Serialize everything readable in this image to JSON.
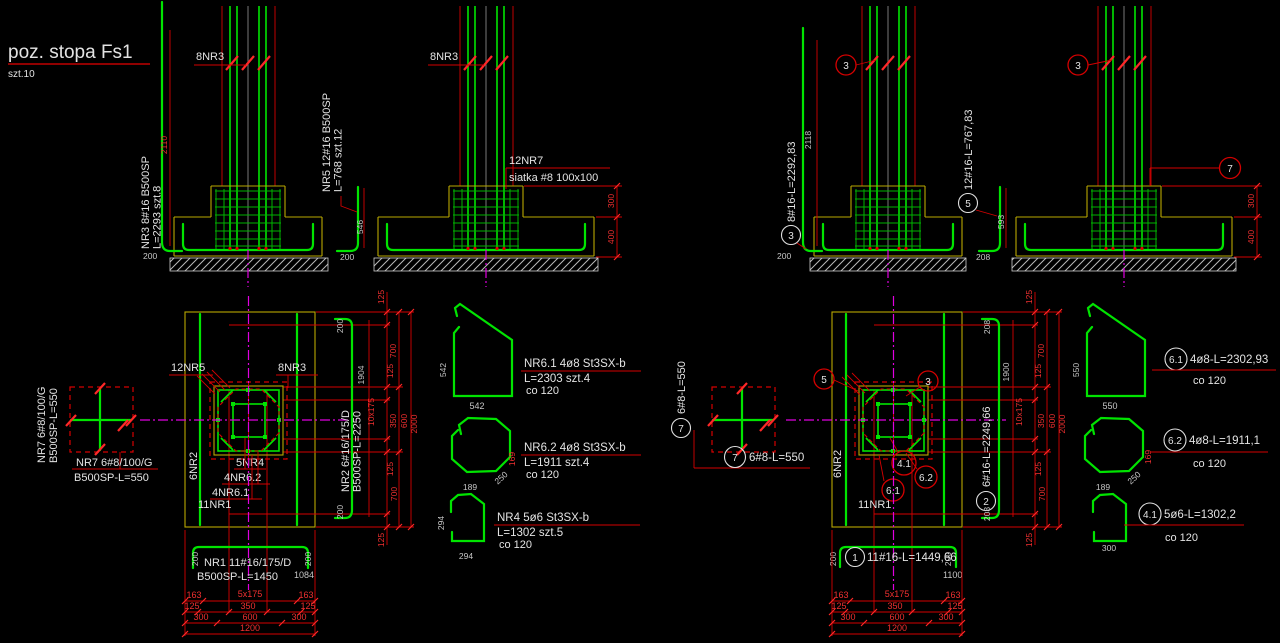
{
  "title": {
    "main": "poz. stopa  Fs1",
    "count": "szt.10"
  },
  "left": {
    "elev1": {
      "bars": "8NR3",
      "bar_name": "NR3  8#16  B500SP",
      "bar_len": "L=2293  szt.8",
      "bar_dim": "2110",
      "hook": "200"
    },
    "elev2": {
      "bars": "8NR3",
      "bar_name": "NR5  12#16  B500SP",
      "bar_len": "L=768  szt.12",
      "bar_dim": "546",
      "hook": "200",
      "mesh1": "12NR7",
      "mesh2": "siatka #8 100x100",
      "dim300": "300",
      "dim400": "400"
    },
    "nr7": {
      "rot1": "NR7 6#8/100/G",
      "rot2": "B500SP-L=550",
      "h1": "NR7 6#8/100/G",
      "h2": "B500SP-L=550"
    },
    "plan": {
      "nr5": "12NR5",
      "nr3": "8NR3",
      "nr2": "6NR2",
      "nr4": "5NR4",
      "nr62": "4NR6.2",
      "nr61": "4NR6.1",
      "nr1": "11NR1",
      "hook_top": "200",
      "bar_dim": "1904",
      "bar_name": "NR2 6#16/175/D",
      "bar_len": "B500SP-L=2250",
      "hook_bot": "200",
      "v125a": "125",
      "v700a": "700",
      "v125b": "125",
      "v10x175": "10x175",
      "v350": "350",
      "v600": "600",
      "v2000": "2000",
      "v125c": "125",
      "v700b": "700",
      "v125d": "125"
    },
    "bar1": {
      "hook_l": "200",
      "hook_r": "200",
      "name": "NR1 11#16/175/D",
      "len": "B500SP-L=1450",
      "dim": "1084"
    },
    "hdim": {
      "a1": "163",
      "a2": "5x175",
      "a3": "163",
      "b1": "125",
      "b2": "350",
      "b3": "125",
      "c1": "300",
      "c2": "600",
      "c3": "300",
      "d1": "1200"
    },
    "d61": {
      "t": "NR6.1  4ø8  St3SX-b",
      "l": "L=2303  szt.4",
      "co": "co 120",
      "dl": "542",
      "db": "542"
    },
    "d62": {
      "t": "NR6.2  4ø8  St3SX-b",
      "l": "L=1911  szt.4",
      "co": "co 120",
      "db": "189",
      "dd": "250",
      "dr": "169"
    },
    "d4": {
      "t": "NR4  5ø6  St3SX-b",
      "l": "L=1302  szt.5",
      "co": "co 120",
      "dl": "294",
      "db": "294"
    }
  },
  "right": {
    "elev1": {
      "callout": "3",
      "no": "3",
      "label": "8#16-L=2292,83",
      "dim": "2118",
      "hook": "200"
    },
    "elev2": {
      "callout": "3",
      "no": "5",
      "label": "12#16-L=767,83",
      "dim": "593",
      "hook": "208",
      "mesh_no": "7",
      "dim300": "300",
      "dim400": "400"
    },
    "nr7": {
      "no": "7",
      "rot": "6#8-L=550",
      "h": "6#8-L=550"
    },
    "plan": {
      "c5": "5",
      "c3": "3",
      "c41": "4.1",
      "c62": "6.2",
      "c61": "6.1",
      "nr1": "11NR1",
      "nr2": "6NR2",
      "no": "2",
      "label": "6#16-L=2249,66",
      "hook_top": "208",
      "bar_dim": "1900",
      "hook_bot": "208",
      "v125a": "125",
      "v700a": "700",
      "v125b": "125",
      "v10x175": "10x175",
      "v350": "350",
      "v600": "600",
      "v2000": "2000",
      "v125c": "125",
      "v700b": "700",
      "v125d": "125"
    },
    "bar1": {
      "no": "1",
      "label": "11#16-L=1449,66",
      "hook_l": "200",
      "hook_r": "200",
      "dim": "1100"
    },
    "hdim": {
      "a1": "163",
      "a2": "5x175",
      "a3": "163",
      "b1": "125",
      "b2": "350",
      "b3": "125",
      "c1": "300",
      "c2": "600",
      "c3": "300",
      "d1": "1200"
    },
    "d61": {
      "no": "6.1",
      "label": "4ø8-L=2302,93",
      "co": "co 120",
      "dl": "550",
      "db": "550"
    },
    "d62": {
      "no": "6.2",
      "label": "4ø8-L=1911,1",
      "co": "co 120",
      "db": "189",
      "dd": "250",
      "dr": "169"
    },
    "d41": {
      "no": "4.1",
      "label": "5ø6-L=1302,2",
      "co": "co 120",
      "db": "300"
    }
  },
  "colors": {
    "green": "#00e400",
    "yellow": "#b9a800",
    "red": "#d40000",
    "magenta": "#e000e0",
    "text": "#e3e3e3",
    "dim_red": "#f03030",
    "dim_gray": "#c6c6c6",
    "bg": "#000000"
  }
}
